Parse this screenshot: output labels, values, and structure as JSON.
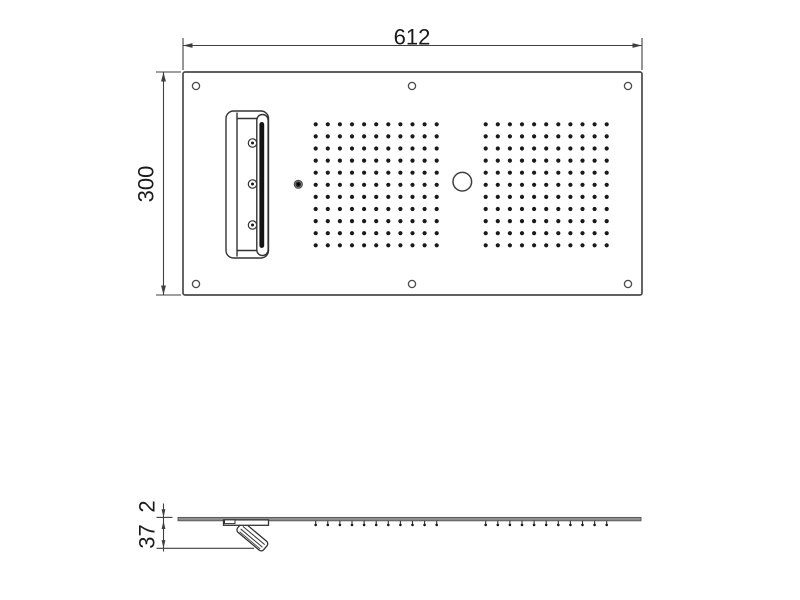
{
  "dimensions": {
    "overall_width": "612",
    "overall_height": "300",
    "panel_thickness": "2",
    "spout_projection": "37"
  },
  "top_view": {
    "panel": {
      "x": 183,
      "y": 72,
      "w": 459,
      "h": 223
    },
    "mounting_holes": [
      [
        196,
        86
      ],
      [
        412,
        86
      ],
      [
        628,
        86
      ],
      [
        196,
        284
      ],
      [
        412,
        284
      ],
      [
        628,
        284
      ]
    ],
    "nozzle_grids": [
      {
        "rows": 11,
        "cols": 11,
        "x": 315.7,
        "y": 124.3,
        "step": 12.1
      },
      {
        "rows": 11,
        "cols": 11,
        "x": 485.7,
        "y": 124.3,
        "step": 12.1
      }
    ],
    "center_circle": {
      "x": 462.3,
      "y": 181.7,
      "r": 9.3
    },
    "screws": [
      [
        252.5,
        143
      ],
      [
        252.5,
        184
      ],
      [
        252.5,
        225
      ]
    ],
    "knob": {
      "x": 298.3,
      "y": 184.3
    }
  },
  "side_view": {
    "panel": {
      "x1": 178,
      "x2": 641,
      "y": 517.4,
      "thickness": 3.4
    },
    "tick_groups": [
      {
        "count": 11,
        "x": 315.7,
        "step": 12.1
      },
      {
        "count": 11,
        "x": 485.7,
        "step": 12.1
      }
    ]
  },
  "colors": {
    "line": "#3f3f3f",
    "thin_line": "#444444",
    "dot": "#1a1a1a",
    "slot": "#141414",
    "panel_gray": "#8f8f8f",
    "background": "#ffffff"
  }
}
